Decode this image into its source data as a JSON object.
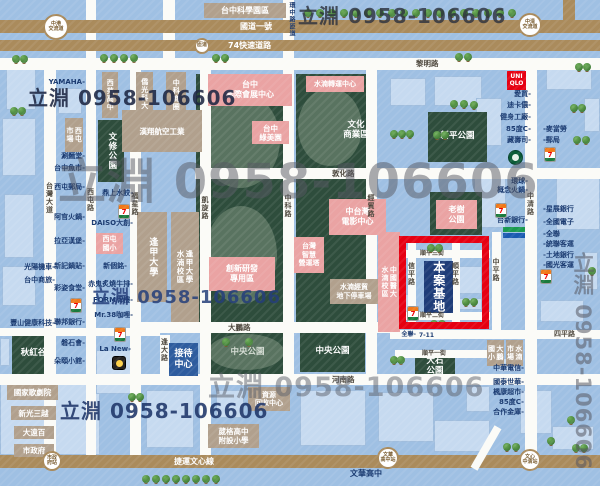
{
  "watermarks": {
    "text": "立淵 0958-106606",
    "items": [
      [
        28,
        88,
        20,
        "rgba(28,38,66,0.88)",
        0
      ],
      [
        298,
        6,
        20,
        "rgba(45,50,62,0.82)",
        0
      ],
      [
        58,
        158,
        48,
        "rgba(85,88,98,0.5)",
        0
      ],
      [
        92,
        289,
        18,
        "rgba(36,62,122,0.85)",
        0
      ],
      [
        208,
        374,
        27,
        "rgba(92,96,106,0.5)",
        0
      ],
      [
        60,
        401,
        20,
        "rgba(30,52,104,0.88)",
        0
      ],
      [
        572,
        252,
        21,
        "rgba(85,88,98,0.55)",
        1
      ]
    ]
  },
  "map": {
    "site_label": "本案基地",
    "site_rect": [
      399,
      236,
      90,
      93
    ],
    "buildings": [
      [
        0,
        378,
        100,
        77
      ],
      [
        6,
        66,
        30,
        44
      ],
      [
        2,
        118,
        34,
        58
      ],
      [
        4,
        194,
        30,
        64
      ],
      [
        2,
        266,
        34,
        40
      ],
      [
        0,
        338,
        10,
        28
      ],
      [
        58,
        88,
        24,
        26
      ],
      [
        390,
        78,
        36,
        28
      ],
      [
        434,
        76,
        48,
        30
      ],
      [
        476,
        98,
        26,
        48
      ],
      [
        474,
        170,
        32,
        58
      ],
      [
        546,
        58,
        46,
        32
      ],
      [
        584,
        98,
        16,
        34
      ],
      [
        556,
        168,
        44,
        62
      ],
      [
        584,
        252,
        14,
        38
      ],
      [
        540,
        300,
        44,
        22
      ],
      [
        498,
        358,
        22,
        14
      ],
      [
        300,
        390,
        66,
        56
      ],
      [
        378,
        392,
        56,
        50
      ],
      [
        434,
        420,
        56,
        32
      ],
      [
        466,
        386,
        24,
        26
      ],
      [
        96,
        350,
        40,
        44
      ],
      [
        146,
        390,
        48,
        58
      ],
      [
        216,
        390,
        28,
        28
      ],
      [
        520,
        390,
        32,
        44
      ],
      [
        552,
        426,
        42,
        24
      ],
      [
        458,
        266,
        24,
        28
      ],
      [
        404,
        294,
        12,
        24
      ],
      [
        458,
        298,
        24,
        12
      ]
    ],
    "parks": [
      [
        196,
        74,
        87,
        248,
        null,
        0
      ],
      [
        296,
        74,
        70,
        248,
        null,
        0
      ],
      [
        428,
        112,
        59,
        50,
        "新平公園",
        0
      ],
      [
        430,
        192,
        52,
        43,
        null,
        0
      ],
      [
        205,
        332,
        85,
        42,
        "中央公園",
        0
      ],
      [
        300,
        332,
        65,
        40,
        "中央公園",
        0
      ],
      [
        415,
        356,
        40,
        22,
        "大石\n公園",
        0
      ],
      [
        12,
        334,
        43,
        40,
        "秋紅谷",
        0
      ],
      [
        98,
        120,
        26,
        62,
        "文修公園",
        1
      ]
    ],
    "ellipses": [
      [
        200,
        92,
        80,
        96
      ],
      [
        205,
        206,
        72,
        98
      ],
      [
        298,
        88,
        64,
        78
      ],
      [
        208,
        334,
        76,
        36
      ]
    ],
    "roads_v": [
      [
        44,
        58,
        12,
        397,
        "minor",
        "台灣大道",
        182
      ],
      [
        86,
        0,
        10,
        455,
        "minor",
        "西屯路",
        188
      ],
      [
        130,
        58,
        11,
        397,
        "minor",
        "福星路",
        192
      ],
      [
        200,
        58,
        11,
        397,
        "minor",
        "凱旋路",
        196
      ],
      [
        283,
        0,
        11,
        374,
        "minor",
        "中科路",
        194
      ],
      [
        366,
        58,
        11,
        316,
        "minor",
        "經貿路",
        194
      ],
      [
        525,
        58,
        12,
        397,
        "minor",
        "中清路",
        192
      ],
      [
        160,
        335,
        10,
        39,
        "minor",
        "逢大路",
        338
      ],
      [
        492,
        232,
        9,
        98,
        "minor",
        "中平路",
        258
      ],
      [
        408,
        240,
        8,
        88,
        "minor",
        "信平路",
        262
      ],
      [
        452,
        240,
        8,
        88,
        "minor",
        "順平路",
        262
      ],
      [
        563,
        0,
        12,
        20,
        "major",
        null,
        0
      ],
      [
        163,
        0,
        12,
        58,
        "minor",
        null,
        0
      ]
    ],
    "roads_h": [
      [
        0,
        20,
        600,
        13,
        "major",
        "國道一號",
        240,
        8
      ],
      [
        0,
        40,
        600,
        11,
        "major",
        "74快速道路",
        228,
        8
      ],
      [
        0,
        58,
        600,
        12,
        "minor",
        "黎明路",
        416,
        7.5
      ],
      [
        195,
        168,
        405,
        11,
        "minor",
        "敦化路",
        332,
        7.5
      ],
      [
        130,
        322,
        262,
        11,
        "minor",
        "大鵬路",
        228,
        7.5
      ],
      [
        390,
        330,
        210,
        9,
        "minor",
        "四平路",
        554,
        7
      ],
      [
        0,
        374,
        600,
        11,
        "minor",
        "河南路",
        332,
        7.5
      ],
      [
        0,
        328,
        160,
        8,
        "minor",
        null,
        0,
        7
      ],
      [
        395,
        350,
        100,
        8,
        "minor",
        "順平一街",
        422,
        6
      ],
      [
        398,
        250,
        92,
        8,
        "minor",
        "順平三街",
        420,
        6
      ],
      [
        398,
        312,
        92,
        8,
        "minor",
        "順平二街",
        420,
        6
      ],
      [
        0,
        455,
        600,
        13,
        "major",
        "捷運文心線",
        174,
        8
      ]
    ],
    "diagonals": [
      [
        482,
        424,
        8,
        48,
        30
      ]
    ],
    "boxes": [
      [
        204,
        3,
        82,
        15,
        "brown",
        "台中科學園區",
        0,
        8
      ],
      [
        102,
        72,
        16,
        46,
        "brown",
        "西苑高中",
        1,
        7
      ],
      [
        136,
        72,
        17,
        44,
        "brown",
        "僑光科大",
        1,
        7
      ],
      [
        166,
        72,
        20,
        46,
        "brown",
        "中科商圈",
        1,
        7
      ],
      [
        122,
        110,
        80,
        42,
        "brown",
        "漢翔航空工業",
        0,
        7.5
      ],
      [
        65,
        118,
        18,
        34,
        "brown",
        "西屯\n市場",
        1,
        7
      ],
      [
        137,
        212,
        30,
        90,
        "brown",
        "逢甲大學",
        1,
        9
      ],
      [
        171,
        212,
        28,
        110,
        "brown",
        "逢甲大學\n水湳校區",
        1,
        7.5
      ],
      [
        330,
        279,
        48,
        25,
        "brown",
        "水湳經貿\n地下停車場",
        0,
        7
      ],
      [
        248,
        387,
        42,
        24,
        "brown",
        "資源\n回收中心",
        0,
        7
      ],
      [
        208,
        424,
        51,
        24,
        "brown",
        "葳格高中\n附設小學",
        0,
        7.5
      ],
      [
        487,
        340,
        17,
        26,
        "brown",
        "大鵬\n國小",
        1,
        7
      ],
      [
        506,
        340,
        17,
        26,
        "brown",
        "水湳\n市場",
        1,
        7
      ],
      [
        7,
        385,
        51,
        15,
        "brown",
        "國家歌劇院",
        0,
        7.5
      ],
      [
        11,
        406,
        45,
        14,
        "brown",
        "新光三越",
        0,
        7.5
      ],
      [
        14,
        426,
        40,
        13,
        "brown",
        "大遠百",
        0,
        7.5
      ],
      [
        14,
        444,
        40,
        13,
        "brown",
        "市政府",
        0,
        7.5
      ],
      [
        208,
        74,
        84,
        32,
        "pink",
        "台中\n國際會展中心",
        0,
        8
      ],
      [
        306,
        76,
        58,
        16,
        "pink",
        "水湳轉運中心",
        0,
        7
      ],
      [
        252,
        121,
        37,
        23,
        "pink",
        "台中\n綠美園",
        0,
        7.5
      ],
      [
        436,
        200,
        41,
        29,
        "pink",
        "老樹\n公園",
        0,
        8
      ],
      [
        329,
        199,
        57,
        36,
        "pink",
        "中台灣\n電影中心",
        0,
        8
      ],
      [
        294,
        237,
        30,
        36,
        "pink",
        "台灣\n智慧\n營運塔",
        0,
        7
      ],
      [
        209,
        257,
        66,
        34,
        "pink",
        "創新研發\n專用區",
        0,
        8
      ],
      [
        378,
        232,
        22,
        100,
        "pink",
        "中國醫大\n水湳校區",
        1,
        7
      ],
      [
        96,
        233,
        27,
        21,
        "pink",
        "西屯\n國小",
        0,
        7
      ],
      [
        507,
        71,
        19,
        19,
        "red",
        "UNI\nQLO",
        0,
        6
      ],
      [
        424,
        261,
        29,
        52,
        "navy",
        "本案基地",
        1,
        12
      ],
      [
        169,
        343,
        29,
        33,
        "blue",
        "接待\n中心",
        0,
        9
      ],
      [
        330,
        117,
        52,
        26,
        "glabel",
        "文化\n商業區",
        0,
        8.5
      ]
    ],
    "stations": [
      [
        56,
        27,
        13,
        "中港\n交流道"
      ],
      [
        530,
        25,
        12,
        "中清\n交流道"
      ],
      [
        202,
        46,
        8,
        "匝道"
      ],
      [
        52,
        461,
        10,
        "市政\n府站"
      ],
      [
        388,
        458,
        11,
        "文華\n高中站"
      ],
      [
        530,
        460,
        11,
        "文心\n中清站"
      ]
    ],
    "labels": [
      [
        55,
        264,
        "光陽機車-",
        "r",
        7
      ],
      [
        55,
        277,
        "台中商旅-",
        "r",
        7
      ],
      [
        55,
        320,
        "豐山健康科技-",
        "r",
        7
      ],
      [
        85,
        79,
        "YAMAHA-",
        "r",
        7
      ],
      [
        85,
        153,
        "涮麵堂-",
        "r",
        7
      ],
      [
        85,
        165,
        "台中魚市-",
        "r",
        7
      ],
      [
        85,
        184,
        "西屯郵局-",
        "r",
        7
      ],
      [
        85,
        214,
        "阿官火鍋-",
        "r",
        7
      ],
      [
        85,
        238,
        "拉亞漢堡-",
        "r",
        7
      ],
      [
        85,
        263,
        "新記鍋貼-",
        "r",
        7
      ],
      [
        85,
        285,
        "彩姿食堂-",
        "r",
        7
      ],
      [
        85,
        319,
        "聯邦銀行-",
        "r",
        7
      ],
      [
        85,
        340,
        "磐石會-",
        "r",
        7
      ],
      [
        85,
        358,
        "朵頤小館-",
        "r",
        7
      ],
      [
        133,
        190,
        "鼎上水餃-",
        "r",
        7
      ],
      [
        133,
        220,
        "DAISO大創-",
        "r",
        7
      ],
      [
        127,
        263,
        "新個銘-",
        "r",
        7
      ],
      [
        133,
        281,
        "赤鬼炙燒牛排-",
        "r",
        7
      ],
      [
        133,
        297,
        "FORM牌樓-",
        "r",
        7
      ],
      [
        133,
        312,
        "Mr.38咖哩-",
        "r",
        7
      ],
      [
        131,
        346,
        "La New-",
        "r",
        7
      ],
      [
        531,
        91,
        "愛買-",
        "r",
        7
      ],
      [
        531,
        102,
        "迪卡儂-",
        "r",
        7
      ],
      [
        531,
        114,
        "健身工廠-",
        "r",
        7
      ],
      [
        531,
        126,
        "85度C-",
        "r",
        7
      ],
      [
        531,
        137,
        "藏壽司-",
        "r",
        7
      ],
      [
        543,
        126,
        "-麥當勞",
        "l",
        7
      ],
      [
        543,
        137,
        "-郵局",
        "l",
        7
      ],
      [
        528,
        178,
        "環球-",
        "r",
        7
      ],
      [
        528,
        187,
        "概念火鍋-",
        "r",
        7
      ],
      [
        528,
        217,
        "台新銀行-",
        "r",
        7
      ],
      [
        543,
        206,
        "-星展銀行",
        "l",
        7
      ],
      [
        543,
        219,
        "-全國電子",
        "l",
        7
      ],
      [
        543,
        231,
        "-全聯",
        "l",
        7
      ],
      [
        543,
        241,
        "-統聯客運",
        "l",
        7
      ],
      [
        543,
        252,
        "-土地銀行",
        "l",
        7
      ],
      [
        543,
        262,
        "-國光客運",
        "l",
        7
      ],
      [
        524,
        365,
        "中華電信-",
        "r",
        7
      ],
      [
        524,
        379,
        "國泰世華-",
        "r",
        7
      ],
      [
        524,
        389,
        "楓康超市-",
        "r",
        7
      ],
      [
        524,
        399,
        "85度C-",
        "r",
        7
      ],
      [
        524,
        409,
        "合作金庫-",
        "r",
        7
      ],
      [
        416,
        332,
        "全聯-",
        "r",
        6
      ],
      [
        419,
        333,
        "7-11",
        "l",
        6
      ],
      [
        350,
        470,
        "文華高中",
        "l",
        8
      ],
      [
        288,
        2,
        "環中路匝道",
        "v",
        6
      ]
    ],
    "icons": [
      [
        118,
        204,
        "seven"
      ],
      [
        70,
        298,
        "seven"
      ],
      [
        544,
        147,
        "seven"
      ],
      [
        495,
        203,
        "seven"
      ],
      [
        540,
        269,
        "seven"
      ],
      [
        114,
        327,
        "seven"
      ],
      [
        407,
        306,
        "seven"
      ],
      [
        508,
        150,
        "sbux"
      ],
      [
        112,
        356,
        "badge"
      ],
      [
        503,
        227,
        "tsb"
      ]
    ],
    "trees": [
      [
        304,
        9
      ],
      [
        316,
        9
      ],
      [
        328,
        9
      ],
      [
        340,
        9
      ],
      [
        352,
        9
      ],
      [
        364,
        9
      ],
      [
        376,
        9
      ],
      [
        388,
        9
      ],
      [
        400,
        9
      ],
      [
        412,
        9
      ],
      [
        424,
        9
      ],
      [
        436,
        9
      ],
      [
        448,
        9
      ],
      [
        460,
        9
      ],
      [
        472,
        9
      ],
      [
        484,
        9
      ],
      [
        496,
        9
      ],
      [
        508,
        9
      ],
      [
        12,
        55
      ],
      [
        20,
        55
      ],
      [
        100,
        54
      ],
      [
        110,
        54
      ],
      [
        120,
        54
      ],
      [
        130,
        54
      ],
      [
        212,
        54
      ],
      [
        221,
        54
      ],
      [
        455,
        53
      ],
      [
        464,
        53
      ],
      [
        575,
        63
      ],
      [
        583,
        63
      ],
      [
        570,
        104
      ],
      [
        578,
        104
      ],
      [
        573,
        136
      ],
      [
        582,
        136
      ],
      [
        10,
        107
      ],
      [
        18,
        107
      ],
      [
        390,
        130
      ],
      [
        398,
        130
      ],
      [
        406,
        130
      ],
      [
        450,
        100
      ],
      [
        460,
        100
      ],
      [
        470,
        101
      ],
      [
        433,
        131
      ],
      [
        441,
        131
      ],
      [
        427,
        244
      ],
      [
        435,
        244
      ],
      [
        462,
        298
      ],
      [
        470,
        298
      ],
      [
        430,
        320
      ],
      [
        438,
        320
      ],
      [
        222,
        338
      ],
      [
        245,
        338
      ],
      [
        390,
        356
      ],
      [
        397,
        356
      ],
      [
        128,
        393
      ],
      [
        136,
        393
      ],
      [
        142,
        475
      ],
      [
        152,
        475
      ],
      [
        162,
        475
      ],
      [
        172,
        475
      ],
      [
        182,
        475
      ],
      [
        192,
        475
      ],
      [
        202,
        475
      ],
      [
        212,
        475
      ],
      [
        503,
        443
      ],
      [
        512,
        443
      ],
      [
        547,
        437
      ],
      [
        567,
        416
      ],
      [
        572,
        444
      ],
      [
        580,
        444
      ],
      [
        588,
        267
      ]
    ]
  }
}
